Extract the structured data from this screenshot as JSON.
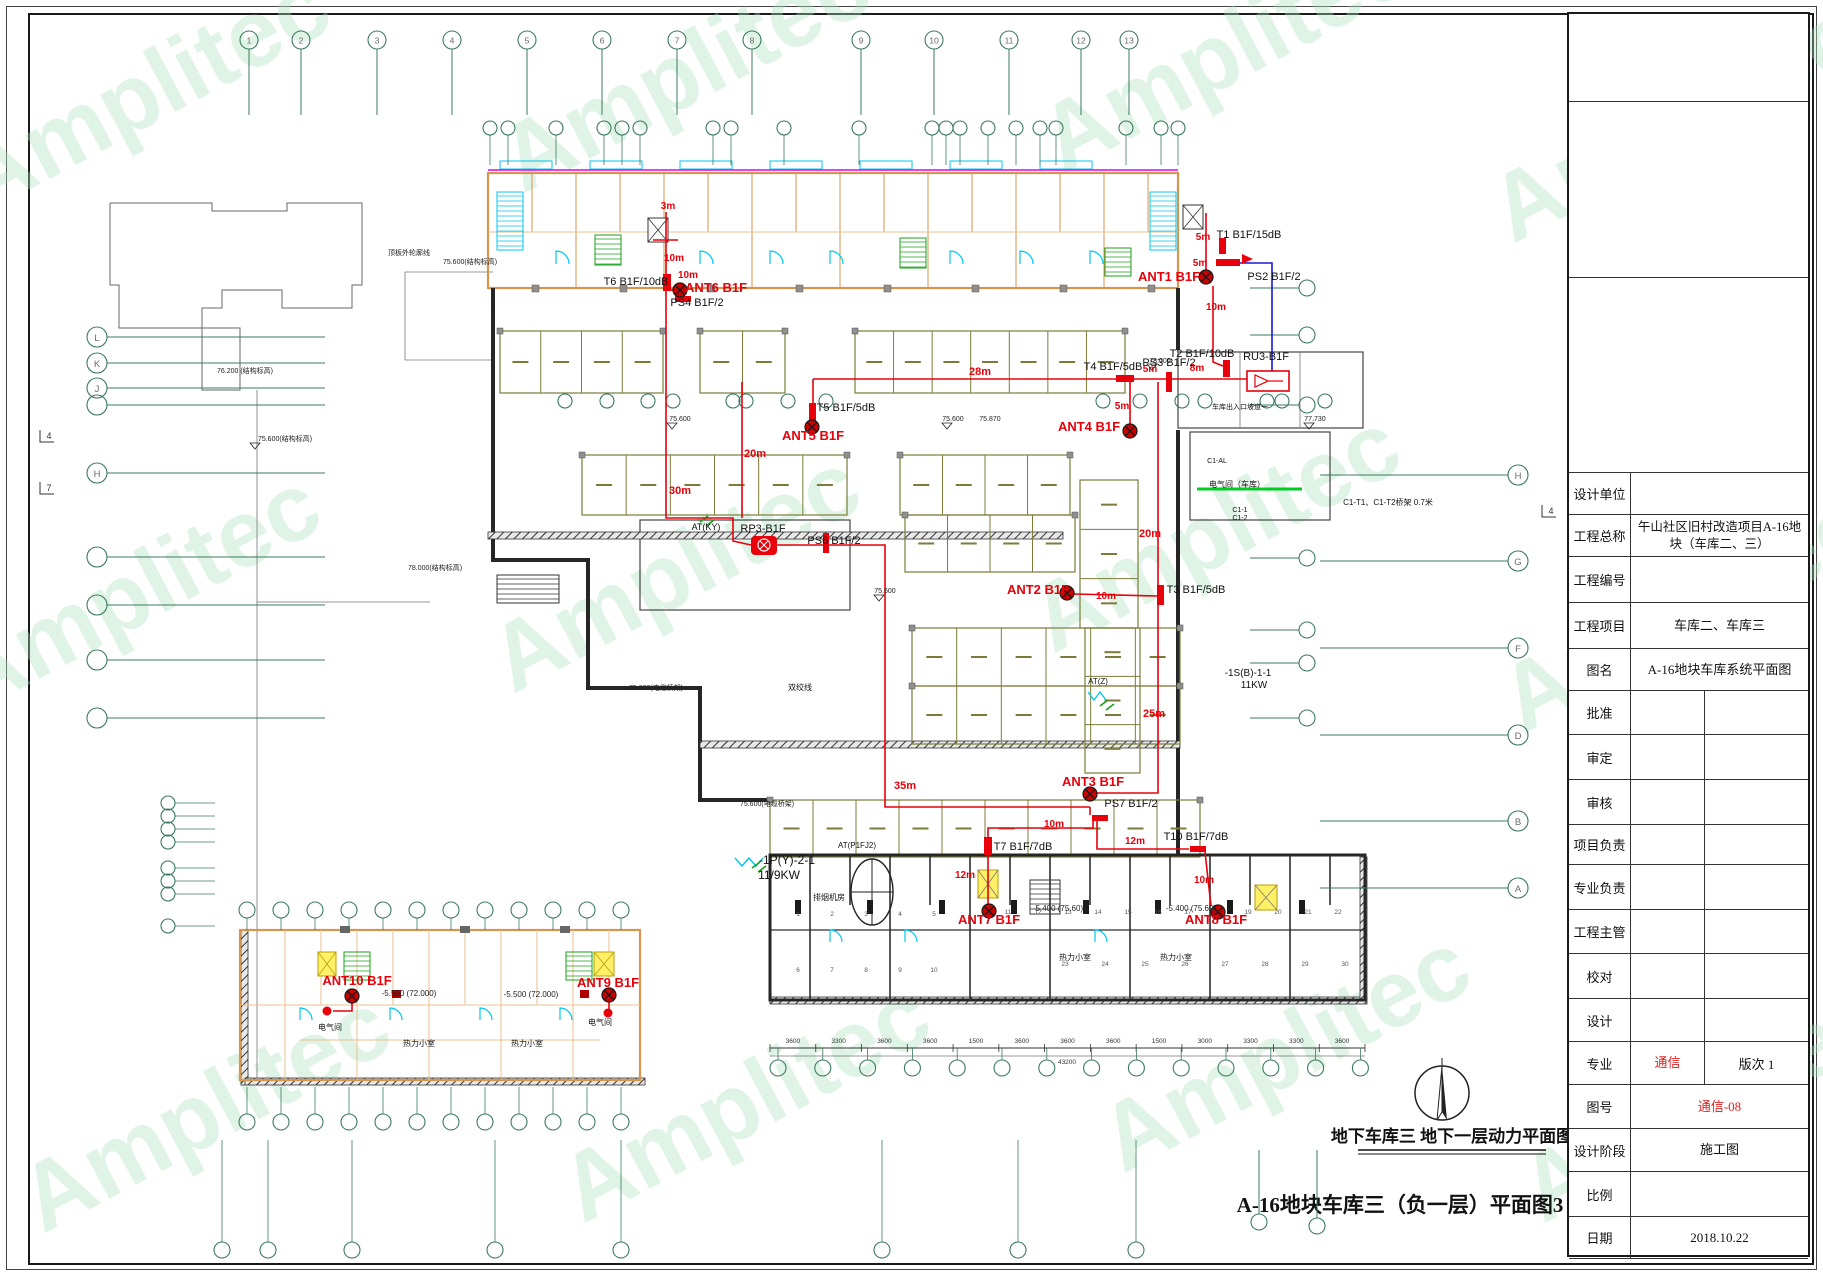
{
  "drawing": {
    "watermark_text": "Amplitec",
    "big_title": "A-16地块车库三（负一层）平面图3",
    "plan_caption": "地下车库三 地下一层动力平面图",
    "red_labels": [
      [
        "3m",
        668,
        209,
        10
      ],
      [
        "10m",
        674,
        261,
        10
      ],
      [
        "10m",
        688,
        278,
        10
      ],
      [
        "ANT6 B1F",
        716,
        292,
        13
      ],
      [
        "5m",
        1203,
        240,
        10
      ],
      [
        "5m",
        1200,
        266,
        10
      ],
      [
        "ANT1 B1F",
        1169,
        281,
        13
      ],
      [
        "10m",
        1216,
        310,
        10
      ],
      [
        "28m",
        980,
        375,
        11
      ],
      [
        "5m",
        1150,
        372,
        10
      ],
      [
        "8m",
        1197,
        371,
        10
      ],
      [
        "5m",
        1122,
        409,
        10
      ],
      [
        "ANT5 B1F",
        813,
        440,
        13
      ],
      [
        "ANT4 B1F",
        1089,
        431,
        13
      ],
      [
        "20m",
        755,
        457,
        11
      ],
      [
        "30m",
        680,
        494,
        11
      ],
      [
        "20m",
        1150,
        537,
        11
      ],
      [
        "ANT2 B1F",
        1038,
        594,
        13
      ],
      [
        "10m",
        1106,
        599,
        10
      ],
      [
        "25m",
        1154,
        717,
        11
      ],
      [
        "35m",
        905,
        789,
        11
      ],
      [
        "ANT3 B1F",
        1093,
        786,
        13
      ],
      [
        "10m",
        1054,
        827,
        10
      ],
      [
        "12m",
        1135,
        844,
        10
      ],
      [
        "12m",
        965,
        878,
        10
      ],
      [
        "10m",
        1204,
        883,
        10
      ],
      [
        "ANT7 B1F",
        989,
        924,
        13
      ],
      [
        "ANT8 B1F",
        1216,
        924,
        13
      ],
      [
        "ANT10 B1F",
        357,
        985,
        13
      ],
      [
        "ANT9 B1F",
        608,
        987,
        13
      ]
    ],
    "black_labels": [
      [
        "T6 B1F/10dB",
        636,
        285,
        11
      ],
      [
        "PS4 B1F/2",
        697,
        306,
        11
      ],
      [
        "T1 B1F/15dB",
        1249,
        238,
        11
      ],
      [
        "PS2 B1F/2",
        1274,
        280,
        11
      ],
      [
        "T2 B1F/10dB",
        1202,
        357,
        11
      ],
      [
        "RU3-B1F",
        1266,
        360,
        11
      ],
      [
        "T4 B1F/5dB",
        1113,
        370,
        11
      ],
      [
        "PS3 B1F/2",
        1169,
        366,
        11
      ],
      [
        "T5 B1F/5dB",
        846,
        411,
        11
      ],
      [
        "RP3-B1F",
        763,
        532,
        11
      ],
      [
        "PS6 B1F/2",
        834,
        544,
        11
      ],
      [
        "AT(KY)",
        706,
        530,
        9
      ],
      [
        "T3 B1F/5dB",
        1196,
        593,
        11
      ],
      [
        "PS7 B1F/2",
        1131,
        807,
        11
      ],
      [
        "T7 B1F/7dB",
        1023,
        850,
        11
      ],
      [
        "T10 B1F/7dB",
        1196,
        840,
        11
      ],
      [
        "AT(P1FJ2)",
        857,
        848,
        8
      ],
      [
        "-1P(Y)-2-1",
        787,
        864,
        12
      ],
      [
        "11/9KW",
        779,
        879,
        12
      ],
      [
        "-1S(B)-1-1",
        1248,
        676,
        10
      ],
      [
        "11KW",
        1254,
        688,
        10
      ],
      [
        "AT(Z)",
        1098,
        684,
        8
      ],
      [
        "电气间（车库）",
        1237,
        487,
        8
      ],
      [
        "车库出入口坡道一",
        1240,
        409,
        7
      ],
      [
        "C1-AL",
        1217,
        463,
        7
      ],
      [
        "C1-1",
        1240,
        512,
        7
      ],
      [
        "C1-2",
        1240,
        520,
        7
      ],
      [
        "C1-T1、C1-T2桥架 0.7米",
        1388,
        505,
        8
      ],
      [
        "双绞线",
        800,
        690,
        8
      ],
      [
        "排烟机房",
        829,
        900,
        8
      ],
      [
        "热力小室",
        1075,
        960,
        8
      ],
      [
        "热力小室",
        1176,
        960,
        8
      ],
      [
        "热力小室",
        419,
        1046,
        8
      ],
      [
        "热力小室",
        527,
        1046,
        8
      ],
      [
        "电气间",
        330,
        1030,
        8
      ],
      [
        "电气间",
        600,
        1025,
        8
      ]
    ],
    "elevation_labels": [
      [
        "76.200 (结构标高)",
        245,
        373,
        7
      ],
      [
        "75.600(结构标高)",
        285,
        441,
        7
      ],
      [
        "顶板外轮廓线",
        409,
        255,
        7
      ],
      [
        "75.600(结构标高)",
        470,
        264,
        7
      ],
      [
        "75.600(结构标高)",
        248,
        378,
        0
      ],
      [
        "78.000(结构标高)",
        435,
        570,
        7
      ],
      [
        "75.600",
        680,
        421,
        7
      ],
      [
        "75.600",
        953,
        421,
        7
      ],
      [
        "75.870",
        990,
        421,
        7
      ],
      [
        "77.730",
        1315,
        421,
        7
      ],
      [
        "78.000",
        1160,
        363,
        7
      ],
      [
        "75.600",
        885,
        593,
        7
      ],
      [
        "75.600(电缆桥架)",
        767,
        806,
        7
      ],
      [
        "75.600(电缆桥架)",
        656,
        690,
        7
      ],
      [
        "-5.500 (72.000)",
        409,
        996,
        8
      ],
      [
        "-5.500 (72.000)",
        531,
        997,
        8
      ],
      [
        "-5.400 (75.60)",
        1058,
        911,
        8
      ],
      [
        "-5.400 (75.60)",
        1191,
        911,
        8
      ]
    ],
    "match_marks": [
      [
        "4",
        46,
        437
      ],
      [
        "7",
        46,
        489
      ],
      [
        "4",
        1548,
        512
      ]
    ],
    "grid": {
      "top_labels": [
        "1",
        "2",
        "3",
        "4",
        "5",
        "6",
        "7",
        "8",
        "9",
        "10",
        "11",
        "12",
        "13"
      ],
      "left_labels": [
        "L",
        "K",
        "J",
        "",
        "H",
        "",
        "",
        "",
        ""
      ],
      "far_right_labels": [
        "H",
        "G",
        "F",
        "D",
        "B",
        "A"
      ]
    },
    "dims": {
      "values": [
        "3600",
        "3300",
        "3600",
        "3600",
        "1500",
        "3600",
        "3600",
        "3600",
        "1500",
        "3000",
        "3300",
        "3300",
        "3600"
      ],
      "total": "43200"
    },
    "room_numbers": [
      "1",
      "2",
      "3",
      "4",
      "5",
      "6",
      "7",
      "8",
      "9",
      "10",
      "11",
      "12",
      "13",
      "14",
      "15",
      "16",
      "17",
      "18",
      "19",
      "20",
      "21",
      "22",
      "23",
      "24",
      "25",
      "26",
      "27",
      "28",
      "29",
      "30"
    ]
  },
  "title_block": {
    "rows": [
      {
        "label": "设计单位",
        "value": ""
      },
      {
        "label": "工程总称",
        "value": "午山社区旧村改造项目A-16地块（车库二、三）"
      },
      {
        "label": "工程编号",
        "value": ""
      },
      {
        "label": "工程项目",
        "value": "车库二、车库三"
      },
      {
        "label": "图名",
        "value": "A-16地块车库系统平面图"
      },
      {
        "label": "批准",
        "value": "",
        "value2": ""
      },
      {
        "label": "审定",
        "value": "",
        "value2": ""
      },
      {
        "label": "审核",
        "value": "",
        "value2": ""
      },
      {
        "label": "项目负责",
        "value": "",
        "value2": ""
      },
      {
        "label": "专业负责",
        "value": "",
        "value2": ""
      },
      {
        "label": "工程主管",
        "value": "",
        "value2": ""
      },
      {
        "label": "校对",
        "value": "",
        "value2": ""
      },
      {
        "label": "设计",
        "value": "",
        "value2": ""
      },
      {
        "label": "专业",
        "value": "通信",
        "red": true,
        "value2": "版次 1"
      },
      {
        "label": "图号",
        "value": "通信-08",
        "red": true
      },
      {
        "label": "设计阶段",
        "value": "施工图"
      },
      {
        "label": "比例",
        "value": ""
      },
      {
        "label": "日期",
        "value": "2018.10.22"
      }
    ]
  }
}
